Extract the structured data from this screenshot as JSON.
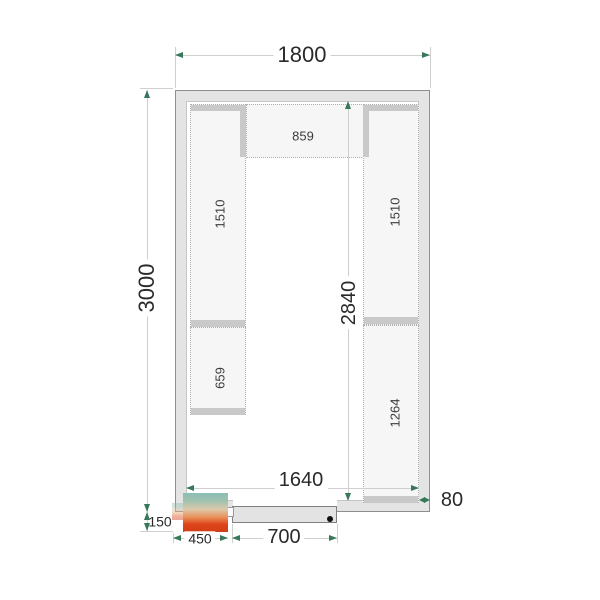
{
  "diagram": {
    "kind": "Cold room floor plan, top view with shelving",
    "dimension_labels": {
      "outer_width": "1800",
      "outer_depth": "3000",
      "inner_depth": "2840",
      "inner_width": "1640",
      "wall_thickness": "80",
      "door_width": "700",
      "unit_width": "450",
      "unit_overhang": "150"
    },
    "shelf_labels": {
      "top_back": "859",
      "left_upper": "1510",
      "left_lower": "659",
      "right_upper": "1510",
      "right_lower": "1264"
    },
    "colors": {
      "wall_fill": "#e4e4e4",
      "wall_edge": "#8f8f8f",
      "shelf_fill": "#f6f6f6",
      "shelf_end_cap": "#c9c9c9",
      "dimension_line": "#cfcfcf",
      "dimension_arrow": "#37785a",
      "dimension_text": "#2a2a2a",
      "unit_gradient_top": "#8bbdb5",
      "unit_gradient_bottom": "#cf3f16",
      "door_handle": "#101010"
    }
  }
}
